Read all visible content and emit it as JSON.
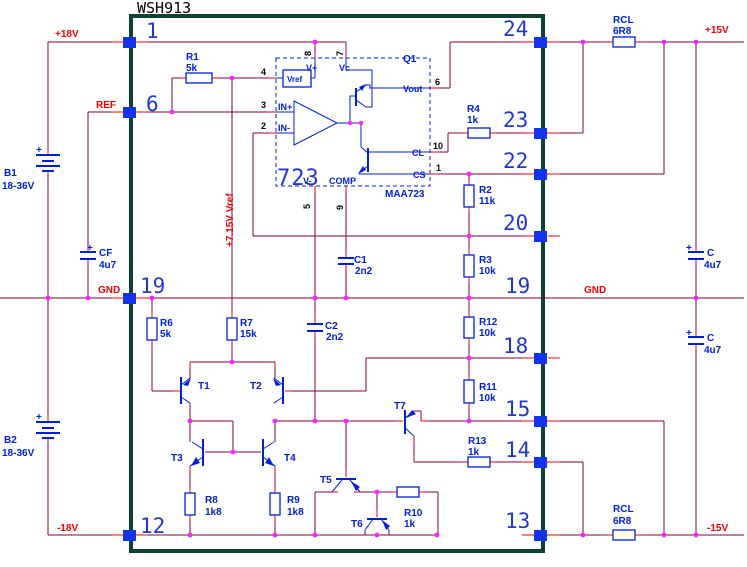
{
  "title": "WSH913",
  "ic": {
    "q1": "Q1",
    "chip": "723",
    "part": "MAA723",
    "vref_box": "Vref",
    "vplus": "V+",
    "vc": "Vc",
    "vminus": "V-",
    "comp": "COMP",
    "vout": "Vout",
    "cl": "CL",
    "cs": "CS",
    "inp": "IN+",
    "inn": "IN-",
    "p1": "1",
    "p2": "2",
    "p3": "3",
    "p4": "4",
    "p5": "5",
    "p6": "6",
    "p7": "7",
    "p8": "8",
    "p9": "9",
    "p10": "10"
  },
  "pins": {
    "l1": "1",
    "l6": "6",
    "l19": "19",
    "l12": "12",
    "r24": "24",
    "r23": "23",
    "r22": "22",
    "r20": "20",
    "r19": "19",
    "r18": "18",
    "r15": "15",
    "r14": "14",
    "r13": "13"
  },
  "rails": {
    "p18v": "+18V",
    "ref": "REF",
    "gnd_l": "GND",
    "n18v": "-18V",
    "p15v": "+15V",
    "gnd_r": "GND",
    "n15v": "-15V",
    "vref_rail": "+7.15V Vref"
  },
  "components": {
    "r1": {
      "n": "R1",
      "v": "5k"
    },
    "r2": {
      "n": "R2",
      "v": "11k"
    },
    "r3": {
      "n": "R3",
      "v": "10k"
    },
    "r4": {
      "n": "R4",
      "v": "1k"
    },
    "r6": {
      "n": "R6",
      "v": "5k"
    },
    "r7": {
      "n": "R7",
      "v": "15k"
    },
    "r8": {
      "n": "R8",
      "v": "1k8"
    },
    "r9": {
      "n": "R9",
      "v": "1k8"
    },
    "r10": {
      "n": "R10",
      "v": "1k"
    },
    "r11": {
      "n": "R11",
      "v": "10k"
    },
    "r12": {
      "n": "R12",
      "v": "10k"
    },
    "r13": {
      "n": "R13",
      "v": "1k"
    },
    "rcl_top": {
      "n": "RCL",
      "v": "6R8"
    },
    "rcl_bot": {
      "n": "RCL",
      "v": "6R8"
    },
    "c1": {
      "n": "C1",
      "v": "2n2"
    },
    "c2": {
      "n": "C2",
      "v": "2n2"
    },
    "cf": {
      "n": "CF",
      "v": "4u7"
    },
    "c_top": {
      "n": "C",
      "v": "4u7"
    },
    "c_bot": {
      "n": "C",
      "v": "4u7"
    },
    "b1": {
      "n": "B1",
      "v": "18-36V"
    },
    "b2": {
      "n": "B2",
      "v": "18-36V"
    },
    "t1": "T1",
    "t2": "T2",
    "t3": "T3",
    "t4": "T4",
    "t5": "T5",
    "t6": "T6",
    "t7": "T7",
    "plus": "+"
  }
}
